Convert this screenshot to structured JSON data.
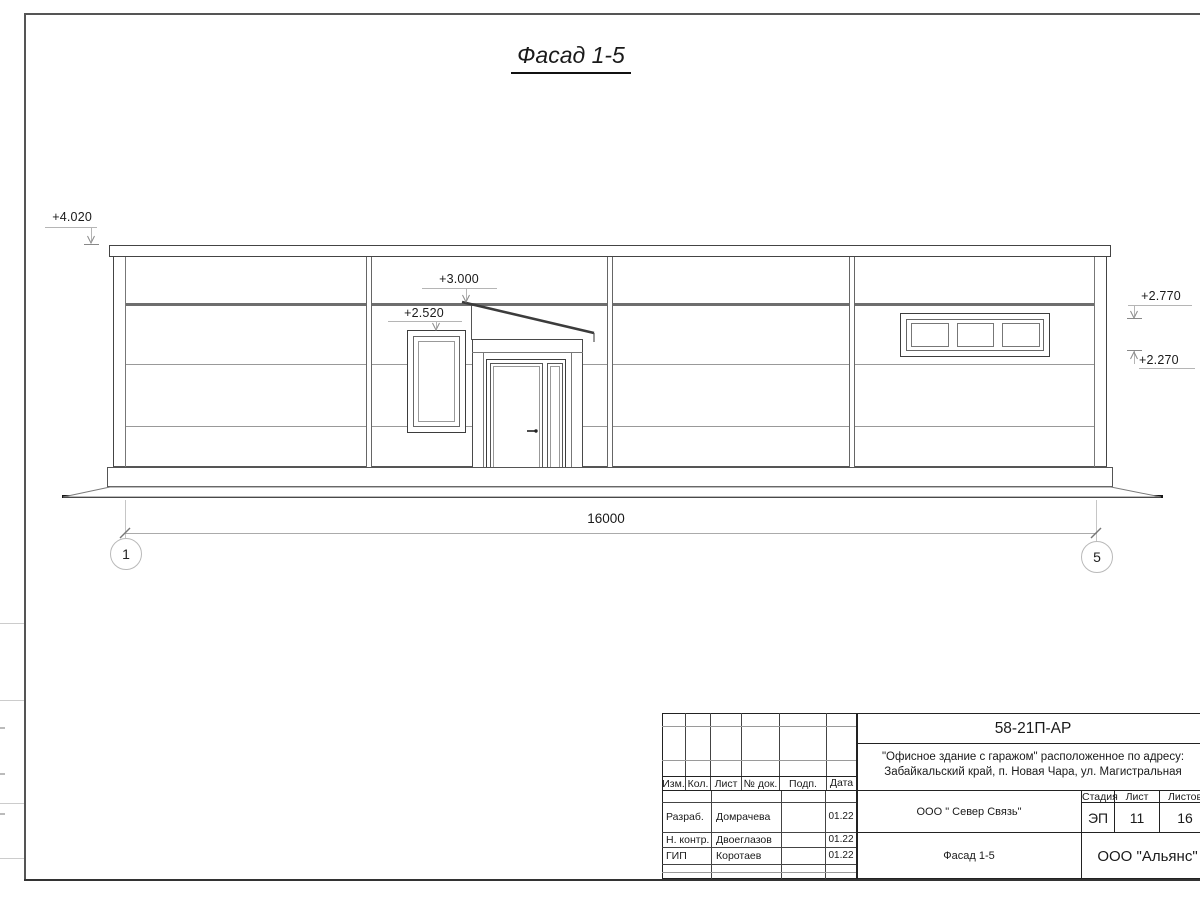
{
  "drawing": {
    "title": "Фасад 1-5",
    "dimension_total": "16000",
    "axis_left": "1",
    "axis_right": "5",
    "elevations": {
      "roof": "+4.020",
      "canopy": "+3.000",
      "left_window": "+2.520",
      "right_window_top": "+2.770",
      "right_window_bottom": "+2.270"
    }
  },
  "title_block": {
    "doc_code": "58-21П-АР",
    "project_line1": "\"Офисное здание с гаражом\" расположенное по адресу:",
    "project_line2": "Забайкальский край, п. Новая Чара, ул. Магистральная",
    "columns": [
      "Изм.",
      "Кол.",
      "Лист",
      "№ док.",
      "Подп.",
      "Дата"
    ],
    "signers": [
      {
        "role": "Разраб.",
        "name": "Домрачева",
        "date": "01.22"
      },
      {
        "role": "Н. контр.",
        "name": "Двоеглазов",
        "date": "01.22"
      },
      {
        "role": "ГИП",
        "name": "Коротаев",
        "date": "01.22"
      }
    ],
    "company": "ООО \" Север Связь\"",
    "sheet_name": "Фасад 1-5",
    "contractor": "ООО \"Альянс\"",
    "stage_label": "Стадия",
    "stage_value": "ЭП",
    "sheet_label": "Лист",
    "sheet_value": "11",
    "sheets_label": "Листов",
    "sheets_value": "16"
  }
}
